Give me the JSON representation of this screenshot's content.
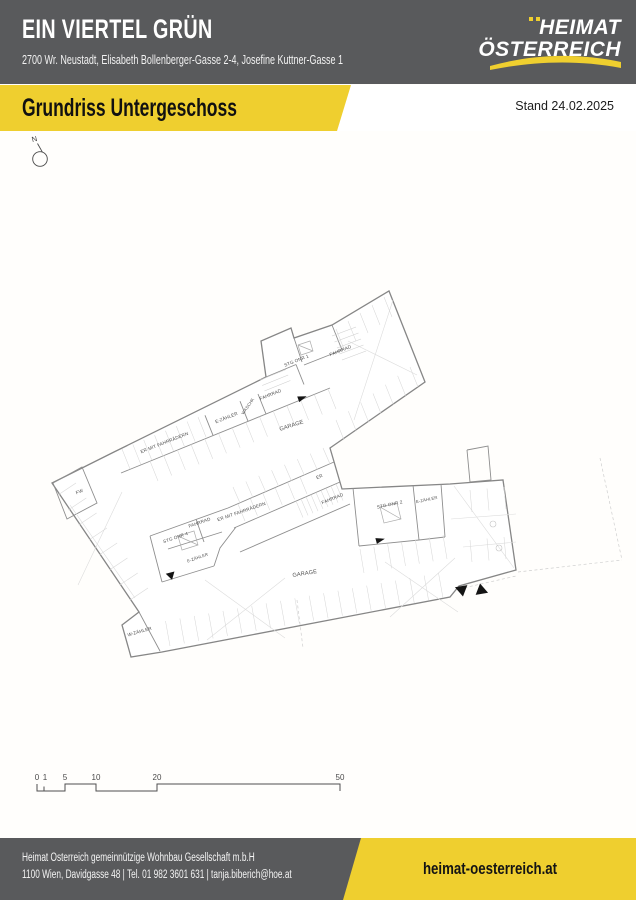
{
  "header": {
    "title": "EIN VIERTEL GRÜN",
    "address": "2700 Wr. Neustadt, Elisabeth Bollenberger-Gasse 2-4, Josefine Kuttner-Gasse 1",
    "logo_line1": "HEIMAT",
    "logo_line2": "ÖSTERREICH"
  },
  "banner": {
    "title": "Grundriss Untergeschoss",
    "date_label": "Stand 24.02.2025"
  },
  "colors": {
    "brand_yellow": "#efcf2f",
    "header_gray": "#595a5c",
    "wall_gray": "#8e8e8e"
  },
  "plan": {
    "north_label": "N",
    "room_labels": [
      {
        "text": "ER MIT FAHRRÄDERN",
        "x": 165,
        "y": 444,
        "rot": -21.5,
        "size": 4.6
      },
      {
        "text": "E-ZÄHLER",
        "x": 227,
        "y": 419,
        "rot": -21.5,
        "size": 4.6
      },
      {
        "text": "WASCHK",
        "x": 249,
        "y": 407,
        "rot": -55,
        "size": 4.2
      },
      {
        "text": "FAHRRAD",
        "x": 271,
        "y": 396,
        "rot": -21.5,
        "size": 4.6
      },
      {
        "text": "STG ONR 1",
        "x": 297,
        "y": 362,
        "rot": -21.5,
        "size": 4.6
      },
      {
        "text": "FAHRRAD",
        "x": 341,
        "y": 352,
        "rot": -21.5,
        "size": 4.6
      },
      {
        "text": "GARAGE",
        "x": 292,
        "y": 427,
        "rot": -18,
        "size": 5.6
      },
      {
        "text": "FW",
        "x": 80,
        "y": 493,
        "rot": -21.5,
        "size": 4.6
      },
      {
        "text": "ER",
        "x": 320,
        "y": 478,
        "rot": -21.5,
        "size": 4.6
      },
      {
        "text": "FAHRRAD",
        "x": 333,
        "y": 500,
        "rot": -21.5,
        "size": 4.6
      },
      {
        "text": "STG ONR 2",
        "x": 390,
        "y": 506,
        "rot": -12,
        "size": 4.6
      },
      {
        "text": "E-ZÄHLER",
        "x": 427,
        "y": 501,
        "rot": -12,
        "size": 4.2
      },
      {
        "text": "ER MIT FAHRRÄDERN",
        "x": 242,
        "y": 513,
        "rot": -19,
        "size": 4.6
      },
      {
        "text": "FAHRRAD",
        "x": 200,
        "y": 524,
        "rot": -19,
        "size": 4.6
      },
      {
        "text": "STG ONR 4",
        "x": 176,
        "y": 539,
        "rot": -19,
        "size": 4.6
      },
      {
        "text": "E-ZÄHLER",
        "x": 198,
        "y": 559,
        "rot": -19,
        "size": 4.2
      },
      {
        "text": "GARAGE",
        "x": 305,
        "y": 575,
        "rot": -9,
        "size": 5.6
      },
      {
        "text": "W-ZÄHLER",
        "x": 140,
        "y": 633,
        "rot": -16,
        "size": 4.6
      }
    ],
    "entry_markers": [
      {
        "dir": "right",
        "x": 302,
        "y": 398,
        "s": 5,
        "rot": -20
      },
      {
        "dir": "right",
        "x": 380,
        "y": 540,
        "s": 5,
        "rot": -15
      },
      {
        "dir": "down",
        "x": 171,
        "y": 576,
        "s": 5,
        "rot": -15
      },
      {
        "dir": "down",
        "x": 462,
        "y": 591,
        "s": 7,
        "rot": -10
      },
      {
        "dir": "up",
        "x": 481,
        "y": 589,
        "s": 7,
        "rot": -10
      }
    ]
  },
  "scale_bar": {
    "labels": [
      {
        "t": "0",
        "x": 37
      },
      {
        "t": "1",
        "x": 45
      },
      {
        "t": "5",
        "x": 65
      },
      {
        "t": "10",
        "x": 96
      },
      {
        "t": "20",
        "x": 157
      },
      {
        "t": "50",
        "x": 340
      }
    ]
  },
  "footer": {
    "company": "Heimat Österreich gemeinnützige Wohnbau Gesellschaft m.b.H",
    "contact": "1100 Wien, Davidgasse 48 | Tel. 01 982 3601 631 | tanja.biberich@hoe.at",
    "website": "heimat-oesterreich.at"
  }
}
